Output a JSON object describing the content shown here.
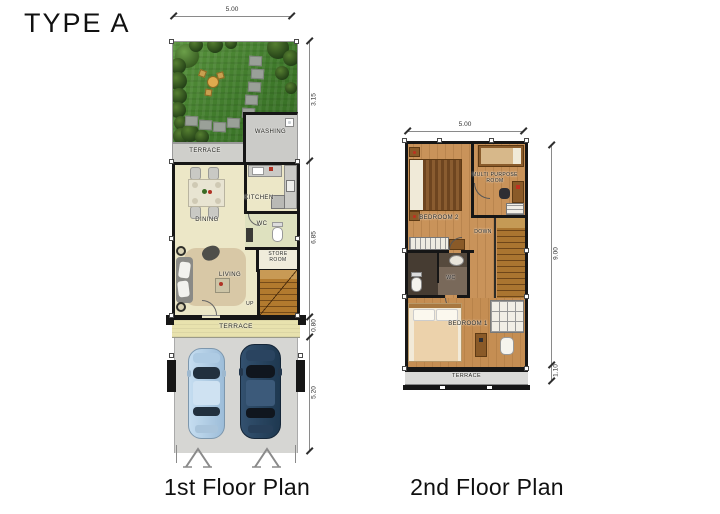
{
  "page": {
    "title": "TYPE A"
  },
  "first_floor": {
    "caption": "1st Floor Plan",
    "dim_top": "5.00",
    "dims_right": [
      "3.15",
      "6.85",
      "0.80",
      "5.20"
    ],
    "rooms": {
      "washing": "WASHING",
      "terrace_top": "TERRACE",
      "kitchen": "KITCHEN",
      "dining": "DINING",
      "wc": "WC",
      "store_room": "STORE ROOM",
      "living": "LIVING",
      "stairs_up": "UP",
      "terrace_bottom": "TERRACE"
    }
  },
  "second_floor": {
    "caption": "2nd Floor Plan",
    "dim_top": "5.00",
    "dims_right": [
      "9.00",
      "1.10"
    ],
    "rooms": {
      "bedroom_2": "BEDROOM 2",
      "multi_purpose": "MULTI PURPOSE ROOM",
      "stairs_down": "DOWN",
      "wc": "WC",
      "bedroom_1": "BEDROOM 1",
      "terrace": "TERRACE"
    }
  },
  "colors": {
    "wall": "#161616",
    "grass": "#4a8533",
    "interior_cream": "#ece7c7",
    "wood_floor": "#c9935a",
    "terrace_khaki": "#e8e2ae",
    "concrete": "#d6d6d3",
    "car_light_blue": "#b9d4ea",
    "car_dark_blue": "#2e4a68"
  }
}
